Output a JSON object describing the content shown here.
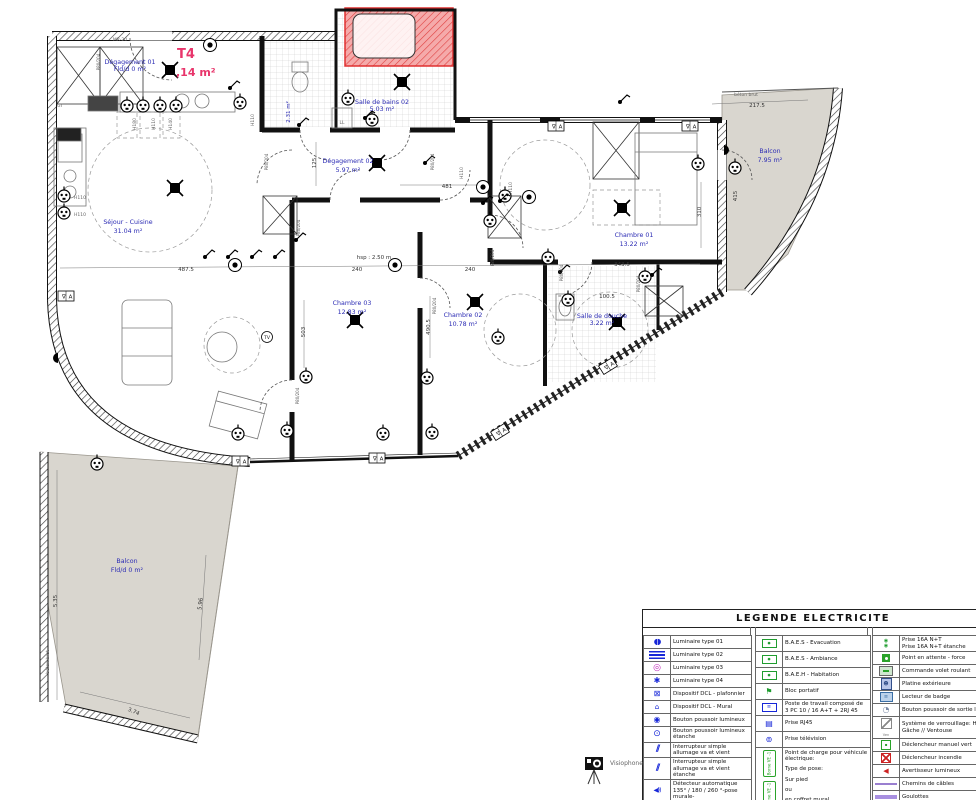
{
  "plan": {
    "title": {
      "text": "T4",
      "area": ",14 m²"
    },
    "rooms": [
      {
        "name": "Dégagement 01",
        "area": "Fld/d 0 m²",
        "x": 130,
        "y": 64,
        "small": true
      },
      {
        "name": "Séjour - Cuisine",
        "area": "31.04 m²",
        "x": 128,
        "y": 224
      },
      {
        "name": "Salle de bains 02",
        "area": "5.03 m²",
        "x": 382,
        "y": 104,
        "small": true
      },
      {
        "name": "Dégagement 02",
        "area": "5.97 m²",
        "x": 348,
        "y": 163
      },
      {
        "name": "Chambre 01",
        "area": "13.22 m²",
        "x": 634,
        "y": 237
      },
      {
        "name": "Chambre 03",
        "area": "12.83 m²",
        "x": 352,
        "y": 305
      },
      {
        "name": "Chambre 02",
        "area": "10.78 m²",
        "x": 463,
        "y": 317
      },
      {
        "name": "Salle de douche",
        "area": "3.22 m²",
        "x": 602,
        "y": 318,
        "small": true
      },
      {
        "name": "Balcon",
        "area": "7.95 m²",
        "x": 770,
        "y": 153
      },
      {
        "name": "Balcon",
        "area": "Fld/d 0 m²",
        "x": 127,
        "y": 563
      }
    ],
    "dimensions": [
      {
        "t": "217.5",
        "x": 757,
        "y": 107
      },
      {
        "t": "487.5",
        "x": 186,
        "y": 271
      },
      {
        "t": "240",
        "x": 357,
        "y": 271
      },
      {
        "t": "240",
        "x": 470,
        "y": 271
      },
      {
        "t": "343.5",
        "x": 622,
        "y": 266
      },
      {
        "t": "481",
        "x": 447,
        "y": 188
      },
      {
        "t": "125",
        "x": 316,
        "y": 163,
        "r": -90
      },
      {
        "t": "503",
        "x": 305,
        "y": 332,
        "r": -90
      },
      {
        "t": "490.5",
        "x": 430,
        "y": 327,
        "r": -90
      },
      {
        "t": "310",
        "x": 701,
        "y": 212,
        "r": -90
      },
      {
        "t": "415",
        "x": 737,
        "y": 196,
        "r": -90
      },
      {
        "t": "100.5",
        "x": 607,
        "y": 298
      },
      {
        "t": "5.35",
        "x": 57,
        "y": 601,
        "r": -90
      },
      {
        "t": "5.96",
        "x": 202,
        "y": 604,
        "r": -83
      },
      {
        "t": "3.74",
        "x": 133,
        "y": 713,
        "r": 23
      },
      {
        "t": "2.31 m²",
        "x": 290,
        "y": 112,
        "r": -90,
        "cls": "blue"
      },
      {
        "t": "hsp : 2.50 m",
        "x": 374,
        "y": 259
      },
      {
        "t": "béton brut",
        "x": 746,
        "y": 96,
        "cls": "tiny"
      },
      {
        "t": "béton brut",
        "x": 49,
        "y": 662,
        "r": -90,
        "cls": "tiny"
      },
      {
        "t": "MR-20",
        "x": 120,
        "y": 41,
        "cls": "tiny"
      },
      {
        "t": "GT",
        "x": 60,
        "y": 107,
        "cls": "tiny"
      },
      {
        "t": "LL",
        "x": 342,
        "y": 124,
        "cls": "tiny"
      },
      {
        "t": "H110",
        "x": 80,
        "y": 199,
        "cls": "tiny"
      },
      {
        "t": "H110",
        "x": 80,
        "y": 216,
        "cls": "tiny"
      },
      {
        "t": "H110",
        "x": 254,
        "y": 120,
        "r": -90,
        "cls": "tiny"
      },
      {
        "t": "H110",
        "x": 463,
        "y": 173,
        "r": -90,
        "cls": "tiny"
      },
      {
        "t": "H110",
        "x": 512,
        "y": 188,
        "r": -90,
        "cls": "tiny"
      },
      {
        "t": "H180",
        "x": 136,
        "y": 124,
        "r": -90,
        "cls": "tiny"
      },
      {
        "t": "H110",
        "x": 155,
        "y": 124,
        "r": -90,
        "cls": "tiny"
      },
      {
        "t": "H140",
        "x": 172,
        "y": 124,
        "r": -90,
        "cls": "tiny"
      }
    ],
    "door_labels": [
      {
        "t": "P80/204",
        "x": 100,
        "y": 62
      },
      {
        "t": "P80/204",
        "x": 268,
        "y": 162
      },
      {
        "t": "P80/204",
        "x": 300,
        "y": 228
      },
      {
        "t": "P80/204",
        "x": 434,
        "y": 162
      },
      {
        "t": "P80/204",
        "x": 299,
        "y": 396
      },
      {
        "t": "P80/204",
        "x": 436,
        "y": 306
      },
      {
        "t": "P80/204",
        "x": 494,
        "y": 258
      },
      {
        "t": "P80/204",
        "x": 563,
        "y": 273
      },
      {
        "t": "P80/204",
        "x": 640,
        "y": 284
      }
    ],
    "symbol_glyphs": {
      "va": "∇A",
      "tv": "TV"
    },
    "symbols": [
      {
        "t": "dcl",
        "x": 170,
        "y": 70
      },
      {
        "t": "dcl",
        "x": 377,
        "y": 163
      },
      {
        "t": "dcl",
        "x": 622,
        "y": 208
      },
      {
        "t": "dcl",
        "x": 355,
        "y": 320
      },
      {
        "t": "dcl",
        "x": 475,
        "y": 302
      },
      {
        "t": "dcl",
        "x": 617,
        "y": 322
      },
      {
        "t": "dcl",
        "x": 402,
        "y": 82
      },
      {
        "t": "dcl",
        "x": 175,
        "y": 188
      },
      {
        "t": "light",
        "x": 235,
        "y": 265
      },
      {
        "t": "light",
        "x": 395,
        "y": 265
      },
      {
        "t": "light",
        "x": 483,
        "y": 187
      },
      {
        "t": "light",
        "x": 529,
        "y": 197
      },
      {
        "t": "light",
        "x": 210,
        "y": 45
      },
      {
        "t": "socket",
        "x": 127,
        "y": 106
      },
      {
        "t": "socket",
        "x": 143,
        "y": 106
      },
      {
        "t": "socket",
        "x": 160,
        "y": 106
      },
      {
        "t": "socket",
        "x": 176,
        "y": 106
      },
      {
        "t": "socket",
        "x": 64,
        "y": 196
      },
      {
        "t": "socket",
        "x": 64,
        "y": 213
      },
      {
        "t": "socket",
        "x": 240,
        "y": 103
      },
      {
        "t": "socket",
        "x": 97,
        "y": 464
      },
      {
        "t": "socket",
        "x": 238,
        "y": 434
      },
      {
        "t": "socket",
        "x": 287,
        "y": 431
      },
      {
        "t": "socket",
        "x": 383,
        "y": 434
      },
      {
        "t": "socket",
        "x": 432,
        "y": 433
      },
      {
        "t": "socket",
        "x": 306,
        "y": 377
      },
      {
        "t": "socket",
        "x": 427,
        "y": 378
      },
      {
        "t": "socket",
        "x": 498,
        "y": 338
      },
      {
        "t": "socket",
        "x": 548,
        "y": 258
      },
      {
        "t": "socket",
        "x": 505,
        "y": 196
      },
      {
        "t": "socket",
        "x": 490,
        "y": 221
      },
      {
        "t": "socket",
        "x": 698,
        "y": 164
      },
      {
        "t": "socket",
        "x": 735,
        "y": 168
      },
      {
        "t": "socket",
        "x": 348,
        "y": 99
      },
      {
        "t": "socket",
        "x": 372,
        "y": 120
      },
      {
        "t": "socket",
        "x": 568,
        "y": 300
      },
      {
        "t": "socket",
        "x": 645,
        "y": 277
      },
      {
        "t": "switch",
        "x": 205,
        "y": 257
      },
      {
        "t": "switch",
        "x": 228,
        "y": 257
      },
      {
        "t": "switch",
        "x": 252,
        "y": 257
      },
      {
        "t": "switch",
        "x": 275,
        "y": 257
      },
      {
        "t": "switch",
        "x": 296,
        "y": 240
      },
      {
        "t": "switch",
        "x": 483,
        "y": 203
      },
      {
        "t": "switch",
        "x": 500,
        "y": 201
      },
      {
        "t": "switch",
        "x": 560,
        "y": 272
      },
      {
        "t": "switch",
        "x": 652,
        "y": 275
      },
      {
        "t": "switch",
        "x": 365,
        "y": 118
      },
      {
        "t": "switch",
        "x": 299,
        "y": 125
      },
      {
        "t": "switch",
        "x": 230,
        "y": 88
      },
      {
        "t": "switch",
        "x": 425,
        "y": 163
      },
      {
        "t": "switch",
        "x": 620,
        "y": 102
      },
      {
        "t": "va",
        "x": 66,
        "y": 296
      },
      {
        "t": "va",
        "x": 240,
        "y": 461
      },
      {
        "t": "va",
        "x": 377,
        "y": 458
      },
      {
        "t": "va",
        "x": 500,
        "y": 432,
        "r": -32
      },
      {
        "t": "va",
        "x": 608,
        "y": 366,
        "r": -32
      },
      {
        "t": "va",
        "x": 556,
        "y": 126
      },
      {
        "t": "va",
        "x": 690,
        "y": 126
      },
      {
        "t": "semi",
        "x": 724,
        "y": 150,
        "r": 90
      },
      {
        "t": "semi",
        "x": 58,
        "y": 358,
        "r": -90
      },
      {
        "t": "tv",
        "x": 267,
        "y": 337
      }
    ]
  },
  "legend": {
    "title": "LEGENDE ELECTRICITE",
    "visiophone": {
      "icon": "visiophone-icon",
      "label": "Visiophone"
    },
    "borne_labels": [
      "Borne VE -1",
      "Borne VE -1"
    ],
    "columns": [
      {
        "rows": [
          {
            "icon": "luminaire-type-01-icon",
            "label": "Luminaire type 01"
          },
          {
            "icon": "luminaire-type-02-icon",
            "label": "Luminaire type 02"
          },
          {
            "icon": "luminaire-type-03-icon",
            "label": "Luminaire type 03"
          },
          {
            "icon": "luminaire-type-04-icon",
            "label": "Luminaire type 04"
          },
          {
            "icon": "dcl-plafonnier-icon",
            "label": "Dispositif DCL - plafonnier"
          },
          {
            "icon": "dcl-mural-icon",
            "label": "Dispositif DCL - Mural"
          },
          {
            "icon": "bouton-poussoir-lumineux-icon",
            "label": "Bouton poussoir lumineux"
          },
          {
            "icon": "bouton-poussoir-lumineux-etanche-icon",
            "label": "Bouton poussoir lumineux étanche"
          },
          {
            "icon": "interrupteur-va-et-vient-icon",
            "label": "Interrupteur simple allumage va et vient"
          },
          {
            "icon": "interrupteur-va-et-vient-etanche-icon",
            "label": "Interrupteur simple allumage va et vient étanche"
          },
          {
            "icon": "detecteur-automatique-mural-icon",
            "label": "Détecteur automatique 135° / 180 / 260 °-pose murale-"
          },
          {
            "icon": "detecteur-special-circulation-icon",
            "label": "Détecteur automatique - Spécial circulation"
          },
          {
            "icon": "detecteur-360-plafond-icon",
            "label": "Détecteur automatique 360° -pose au plafond"
          }
        ]
      },
      {
        "rows": [
          {
            "icon": "baes-evacuation-icon",
            "label": "B.A.E.S - Evacuation"
          },
          {
            "icon": "baes-ambiance-icon",
            "label": "B.A.E.S - Ambiance"
          },
          {
            "icon": "baeh-habitation-icon",
            "label": "B.A.E.H - Habitation"
          },
          {
            "icon": "bloc-portatif-icon",
            "label": "Bloc portatif"
          },
          {
            "icon": "poste-de-travail-icon",
            "label": "Poste de travail composé de 3 PC 10 / 16 A+T + 2RJ 45"
          },
          {
            "icon": "prise-rj45-icon",
            "label": "Prise RJ45"
          },
          {
            "icon": "prise-television-icon",
            "label": "Prise télévision"
          },
          {
            "icon": "borne-ve-icon",
            "tall": true,
            "lines": [
              "Point de charge pour véhicule électrique:",
              "Type de pose:",
              "Sur pied",
              "ou",
              "en coffret mural"
            ]
          }
        ]
      },
      {
        "rows": [
          {
            "icon": "prise-16a-icon",
            "label": "Prise 16A N+T",
            "label2": "Prise 16A N+T étanche",
            "h": 16
          },
          {
            "icon": "point-attente-force-icon",
            "label": "Point en attente - force"
          },
          {
            "icon": "commande-volet-roulant-icon",
            "label": "Commande volet roulant"
          },
          {
            "icon": "platine-exterieure-icon",
            "label": "Platine extérieure"
          },
          {
            "icon": "lecteur-badge-icon",
            "label": "Lecteur de badge"
          },
          {
            "icon": "bouton-sortie-libre-icon",
            "label": "Bouton poussoir de sortie libre"
          },
          {
            "icon": "systeme-verrouillage-icon",
            "icon_text": "Ven",
            "label": "Système de verrouillage: Hors lot",
            "label2": "Gâche // Ventouse",
            "h": 22
          },
          {
            "icon": "declencheur-manuel-vert-icon",
            "label": "Déclencheur manuel vert"
          },
          {
            "icon": "declencheur-incendie-icon",
            "label": "Déclencheur incendie"
          },
          {
            "icon": "avertisseur-lumineux-icon",
            "label": "Avertisseur lumineux"
          },
          {
            "icon": "chemins-de-cables-icon",
            "label": "Chemins de câbles"
          },
          {
            "icon": "goulottes-icon",
            "label": "Goulottes"
          }
        ]
      }
    ]
  }
}
